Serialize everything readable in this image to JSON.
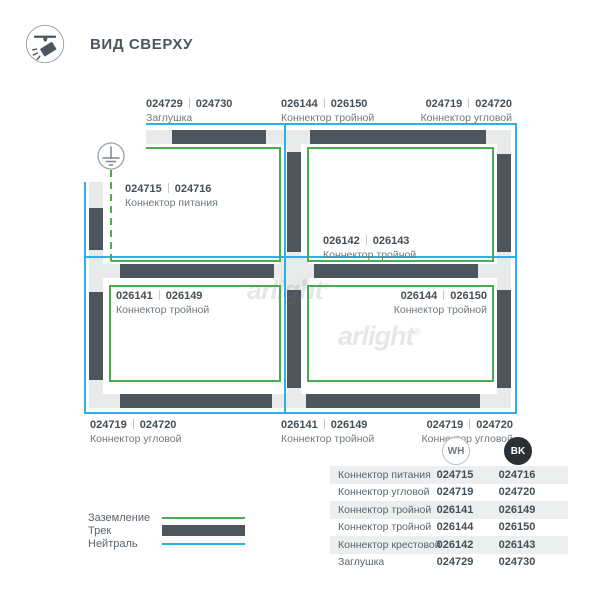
{
  "header": {
    "title": "ВИД СВЕРХУ"
  },
  "watermark": {
    "text": "arlight",
    "reg": "®"
  },
  "diagram_labels": {
    "top_cap": {
      "wh": "024729",
      "bk": "024730",
      "name": "Заглушка"
    },
    "top_t": {
      "wh": "026144",
      "bk": "026150",
      "name": "Коннектор тройной"
    },
    "top_corner": {
      "wh": "024719",
      "bk": "024720",
      "name": "Коннектор угловой"
    },
    "power": {
      "wh": "024715",
      "bk": "024716",
      "name": "Коннектор питания"
    },
    "center_cross": {
      "wh": "026142",
      "bk": "026143",
      "name": "Коннектор тройной"
    },
    "left_t": {
      "wh": "026141",
      "bk": "026149",
      "name": "Коннектор тройной"
    },
    "right_t": {
      "wh": "026144",
      "bk": "026150",
      "name": "Коннектор тройной"
    },
    "bottom_left_corner": {
      "wh": "024719",
      "bk": "024720",
      "name": "Коннектор угловой"
    },
    "bottom_t": {
      "wh": "026141",
      "bk": "026149",
      "name": "Коннектор тройной"
    },
    "bottom_right_corner": {
      "wh": "024719",
      "bk": "024720",
      "name": "Коннектор угловой"
    }
  },
  "legend": {
    "items": [
      {
        "label": "Заземление",
        "color": "#4aad4f"
      },
      {
        "label": "Трек",
        "color": "#4d565c"
      },
      {
        "label": "Нейтраль",
        "color": "#2bb0e8"
      }
    ]
  },
  "table": {
    "columns": {
      "wh": "WH",
      "bk": "BK"
    },
    "rows": [
      {
        "name": "Коннектор питания",
        "wh": "024715",
        "bk": "024716"
      },
      {
        "name": "Коннектор угловой",
        "wh": "024719",
        "bk": "024720"
      },
      {
        "name": "Коннектор тройной",
        "wh": "026141",
        "bk": "026149"
      },
      {
        "name": "Коннектор тройной",
        "wh": "026144",
        "bk": "026150"
      },
      {
        "name": "Коннектор крестовой",
        "wh": "026142",
        "bk": "026143"
      },
      {
        "name": "Заглушка",
        "wh": "024729",
        "bk": "024730"
      }
    ]
  },
  "colors": {
    "track": "#4d565c",
    "rail": "#e9ebeb",
    "ground_green": "#4aad4f",
    "neutral_blue": "#2bb0e8",
    "row_shade": "#edefef",
    "bk_badge": "#2b3034",
    "code_text": "#454e55",
    "label_text": "#6e787e"
  }
}
